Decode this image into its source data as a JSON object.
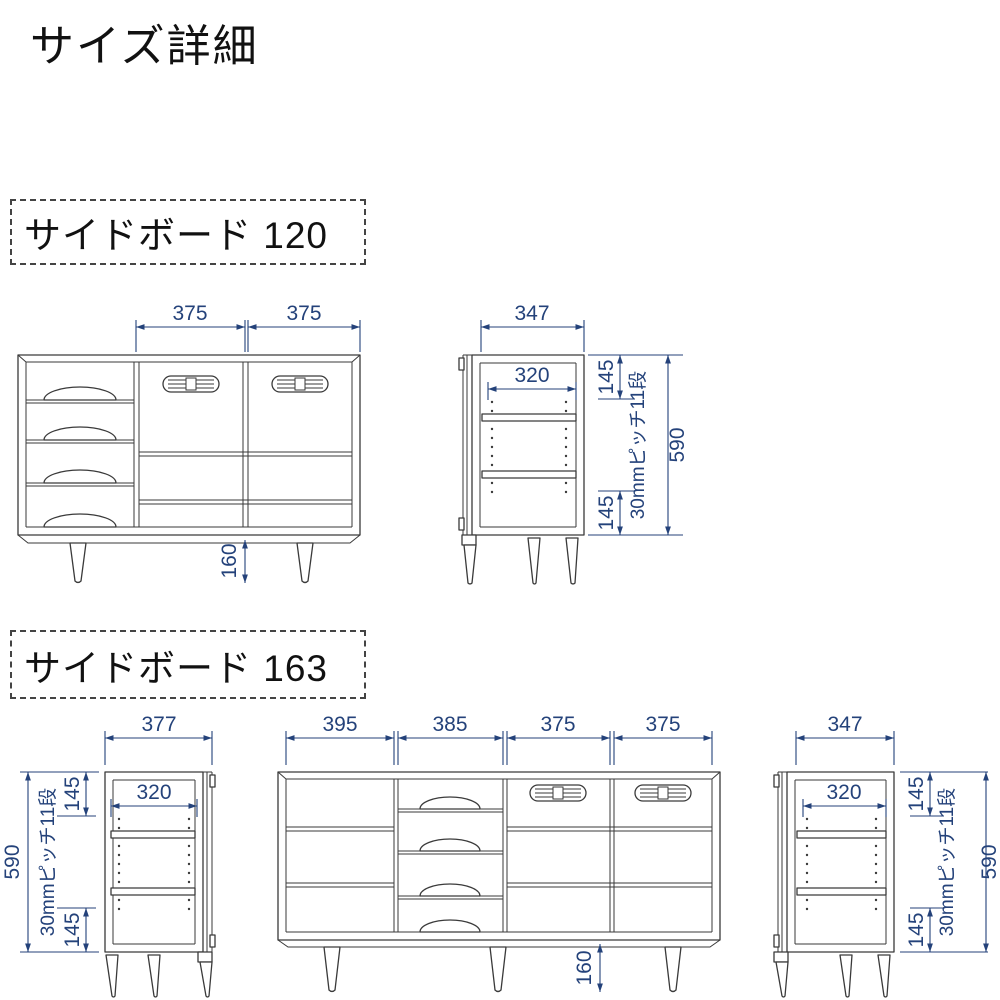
{
  "page": {
    "title": "サイズ詳細"
  },
  "colors": {
    "dimension": "#24427a",
    "outline": "#3a3a3a",
    "background": "#ffffff"
  },
  "sideboard120": {
    "label": "サイドボード 120",
    "front": {
      "door_width_left": "375",
      "door_width_right": "375",
      "leg_height": "160"
    },
    "side": {
      "depth": "347",
      "inner_depth": "320",
      "top_offset": "145",
      "bottom_offset": "145",
      "shelf_pitch": "30mmピッチ11段",
      "height": "590"
    }
  },
  "sideboard163": {
    "label": "サイドボード 163",
    "left_side": {
      "depth": "377",
      "inner_depth": "320",
      "top_offset": "145",
      "bottom_offset": "145",
      "shelf_pitch": "30mmピッチ11段",
      "height": "590"
    },
    "front": {
      "bay_widths": [
        "395",
        "385",
        "375",
        "375"
      ],
      "leg_height": "160"
    },
    "right_side": {
      "depth": "347",
      "inner_depth": "320",
      "top_offset": "145",
      "bottom_offset": "145",
      "shelf_pitch": "30mmピッチ11段",
      "height": "590"
    }
  }
}
